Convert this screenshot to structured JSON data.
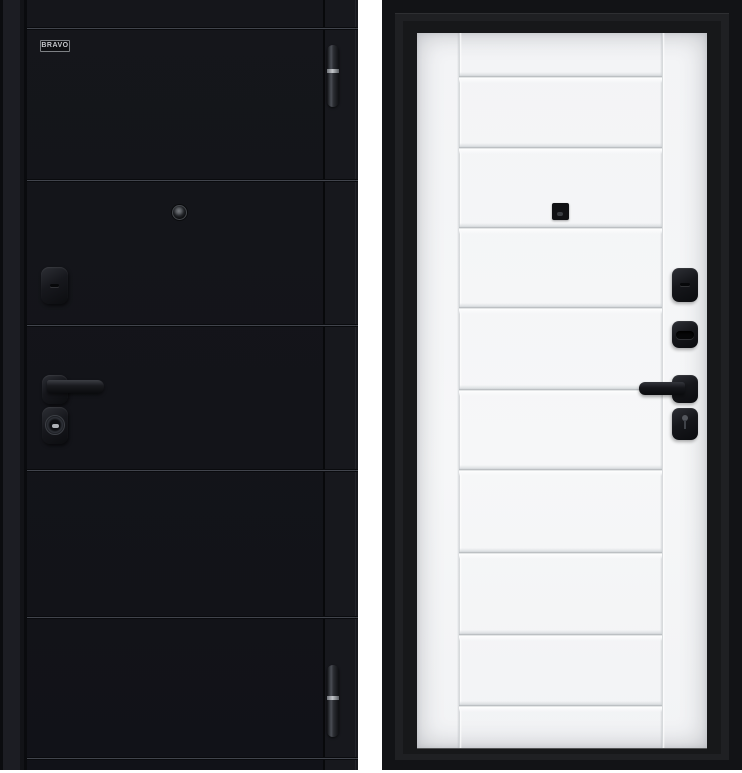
{
  "page": {
    "background_color": "#ffffff"
  },
  "left_door": {
    "view": "exterior-black-panel",
    "brand_label": "BRAVO",
    "leaf_color": "#15161b",
    "groove_y_px": [
      28,
      180,
      325,
      470,
      617,
      758
    ],
    "hardware": [
      "peephole",
      "night-latch-escutcheon",
      "lever-handle",
      "cylinder-escutcheon"
    ],
    "hinge_count": 2
  },
  "right_door": {
    "view": "interior-white-panel",
    "leaf_color": "#f5f6f7",
    "frame_color": "#151517",
    "panel_line_y_px": [
      44,
      115,
      195,
      275,
      357,
      437,
      520,
      602,
      673
    ],
    "hardware": [
      "peephole",
      "night-latch-knob",
      "thumbturn",
      "lever-handle",
      "wc-escutcheon"
    ]
  }
}
